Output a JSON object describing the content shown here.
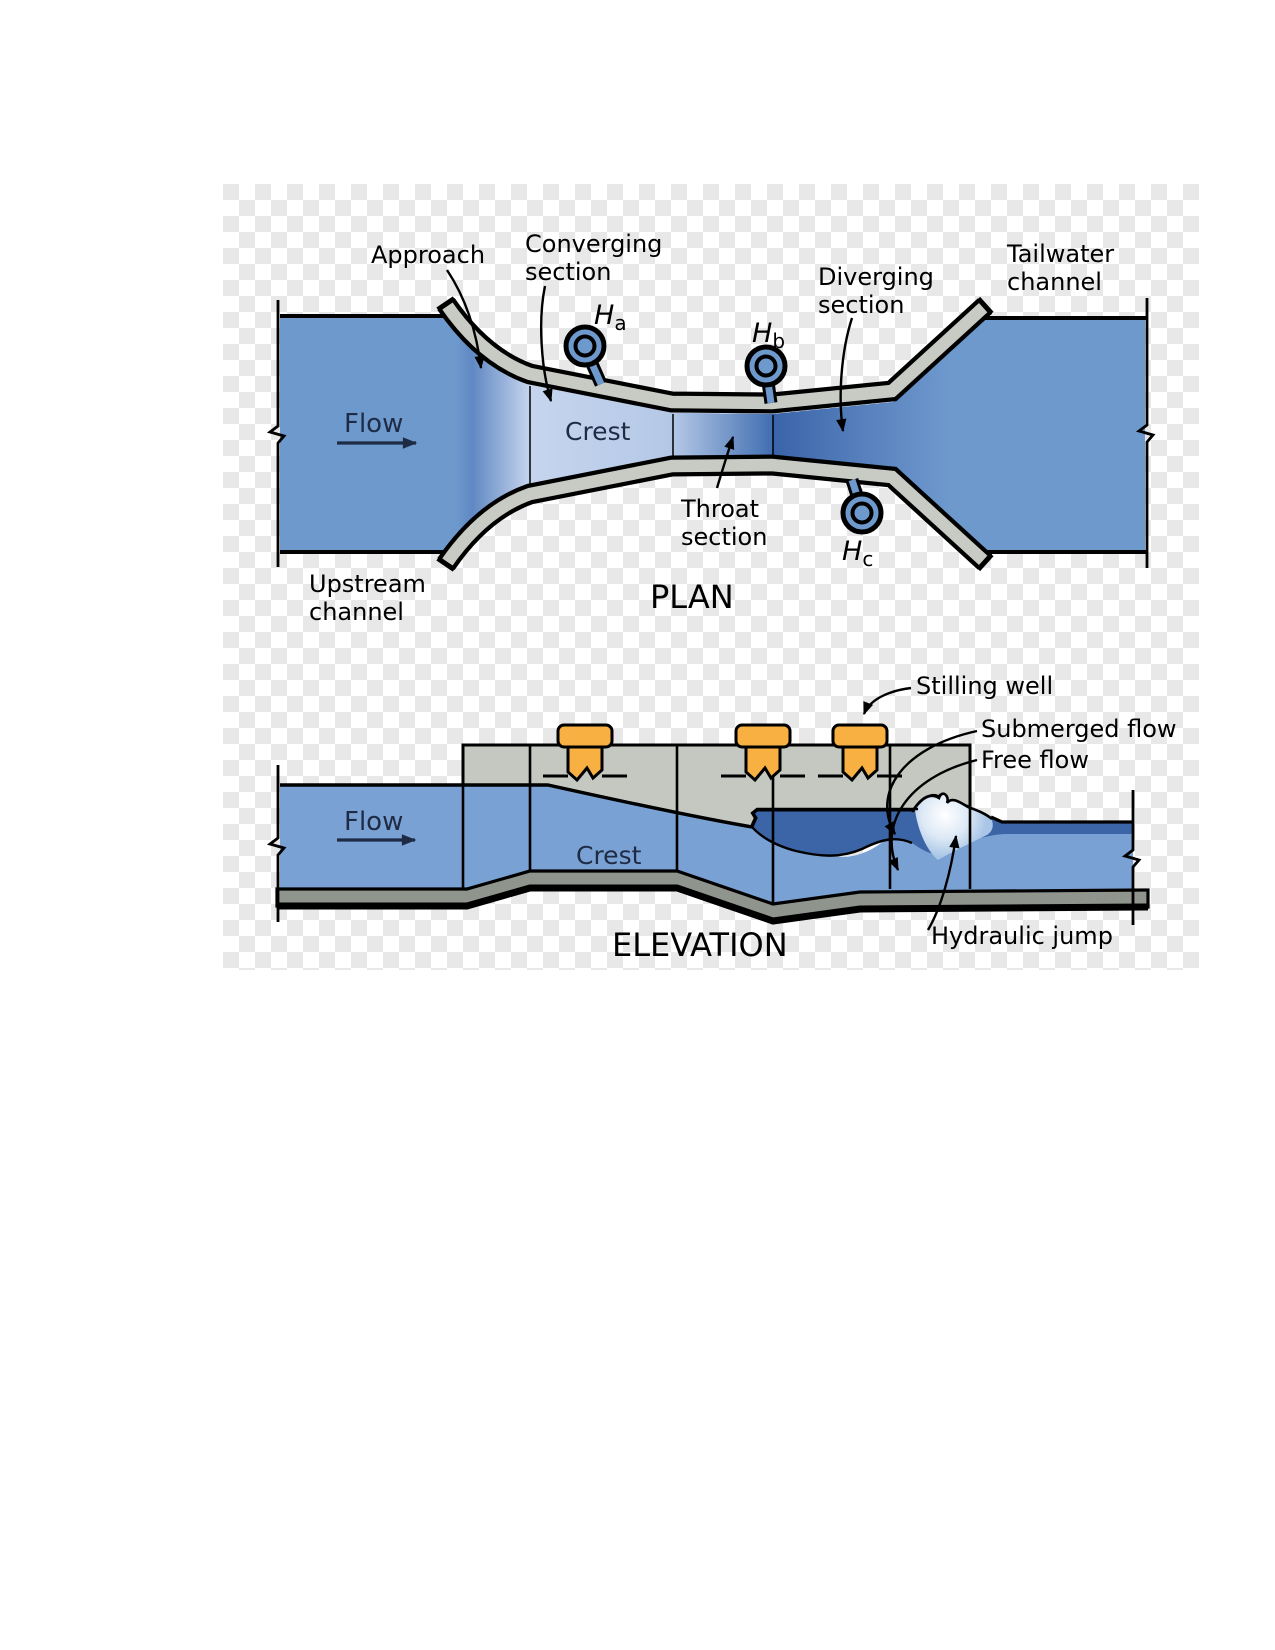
{
  "figure": {
    "name": "Parshall flume measurement structure diagram",
    "views": [
      "PLAN",
      "ELEVATION"
    ]
  },
  "plan": {
    "title": "PLAN",
    "labels": {
      "approach": "Approach",
      "converging_1": "Converging",
      "converging_2": "section",
      "diverging_1": "Diverging",
      "diverging_2": "section",
      "throat_1": "Throat",
      "throat_2": "section",
      "tailwater_1": "Tailwater",
      "tailwater_2": "channel",
      "upstream_1": "Upstream",
      "upstream_2": "channel",
      "crest": "Crest",
      "flow": "Flow"
    },
    "gauges": [
      {
        "sym": "H",
        "sub": "a"
      },
      {
        "sym": "H",
        "sub": "b"
      },
      {
        "sym": "H",
        "sub": "c"
      }
    ]
  },
  "elevation": {
    "title": "ELEVATION",
    "labels": {
      "flow": "Flow",
      "crest": "Crest",
      "stilling_well": "Stilling well",
      "submerged_flow": "Submerged flow",
      "free_flow": "Free flow",
      "hydraulic_jump": "Hydraulic jump"
    }
  },
  "colors": {
    "channel_blue": "#6e99cd",
    "crest_light_blue": "#c6d5ee",
    "deep_blue": "#3a64a9",
    "elevation_water": "#7aa1d3",
    "submerged_dark": "#3b65a7",
    "wall_grey": "#c8cbc3",
    "structure_grey": "#c5c8c1",
    "floor_grey": "#8f948c",
    "stilling_well_orange": "#f8b042",
    "flow_text_navy": "#1e2b45",
    "checker_grey": "#e8e8e8",
    "outline_black": "#000000"
  }
}
